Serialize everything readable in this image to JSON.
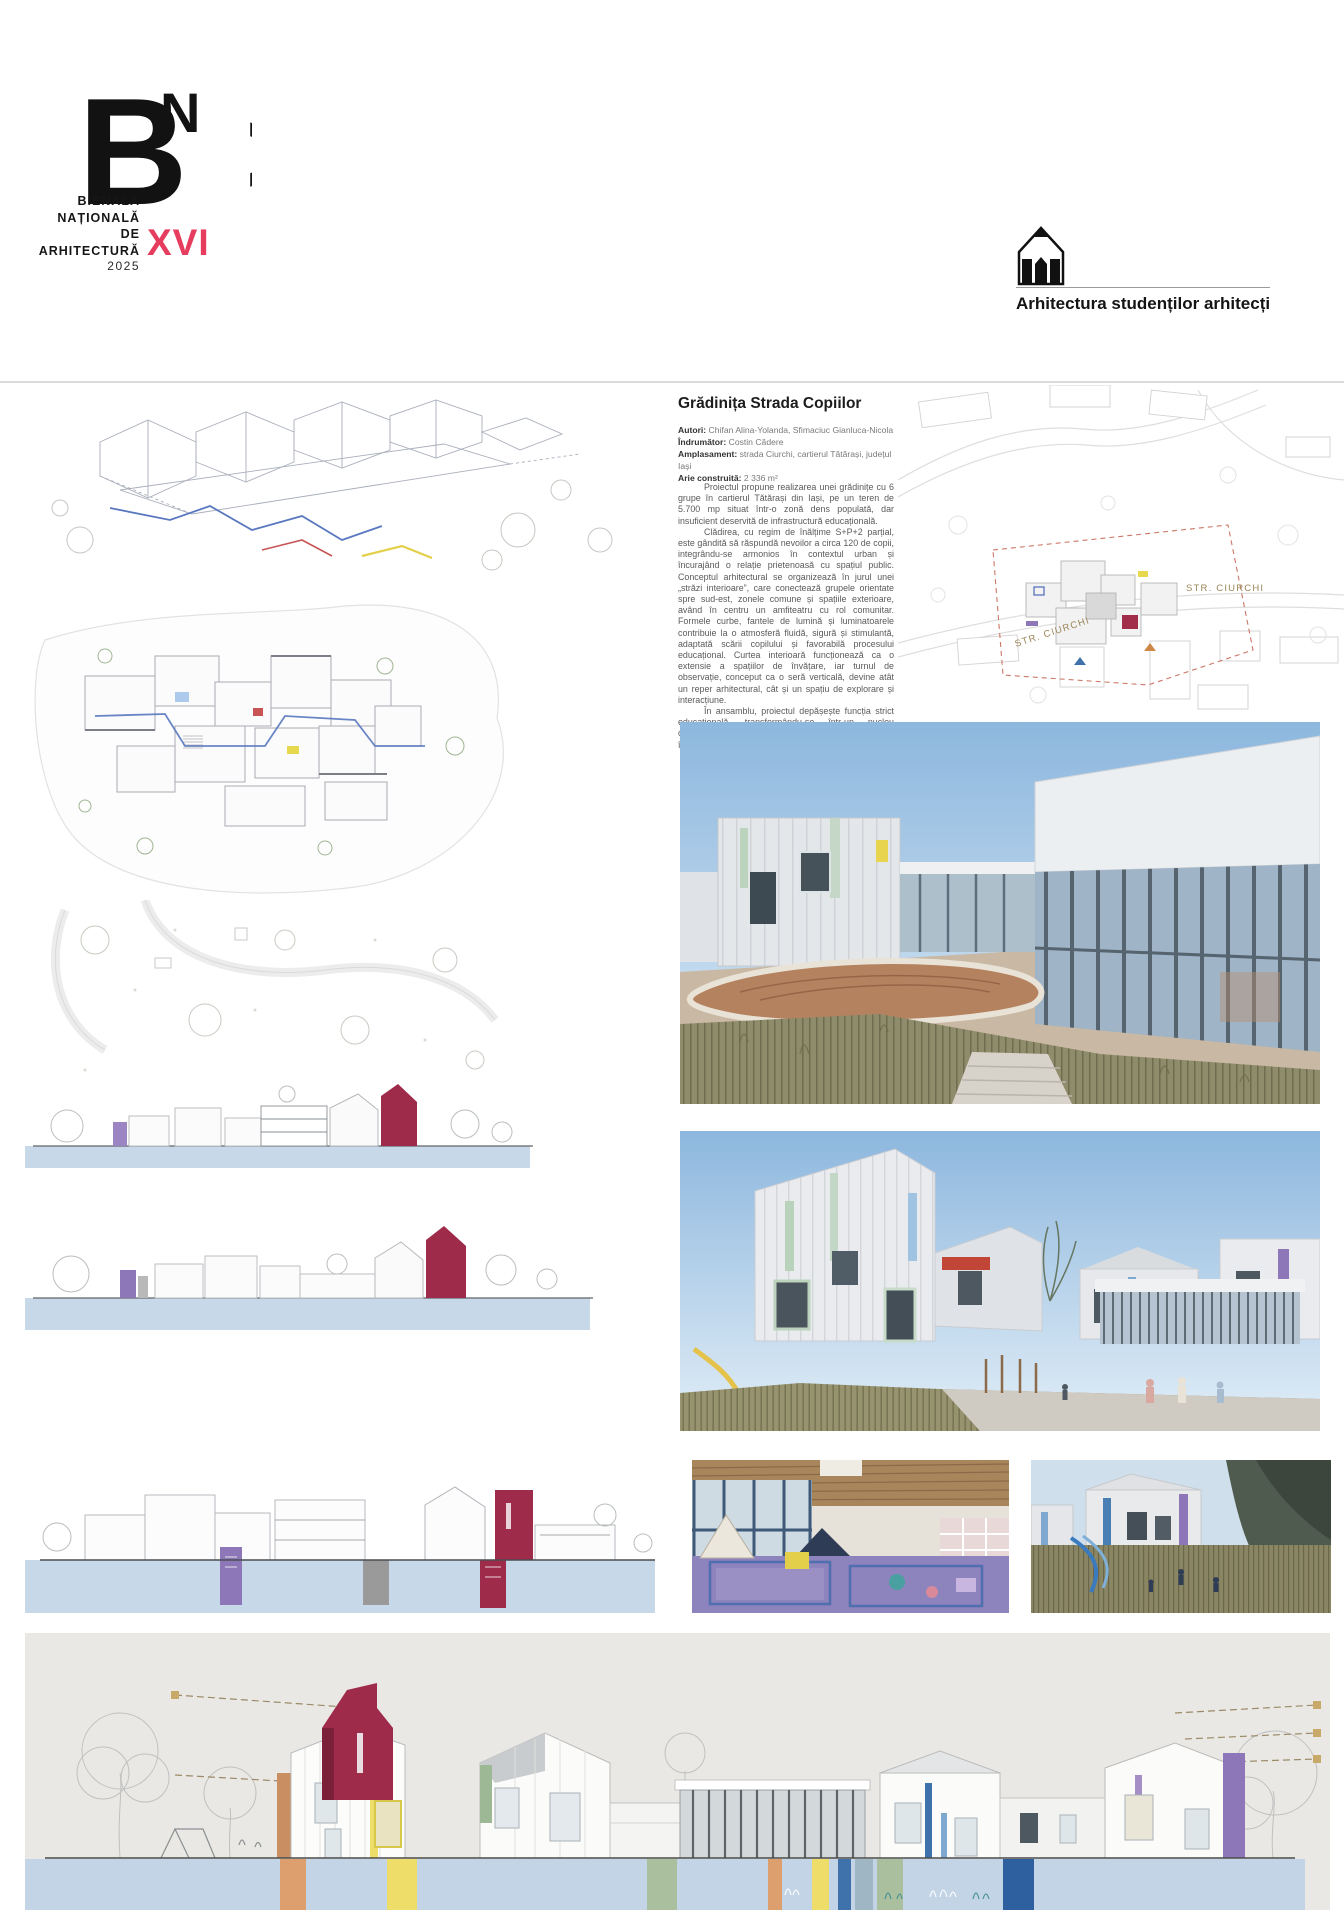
{
  "header": {
    "logo": {
      "mark": "BNA",
      "lines": [
        "BIENALA",
        "NAȚIONALĂ",
        "DE",
        "ARHITECTURĂ"
      ],
      "year": "2025",
      "edition": "XVI",
      "edition_color": "#e63d5f"
    },
    "section": {
      "icon": "pencil-house-icon",
      "label": "Arhitectura studenților arhitecți"
    }
  },
  "project": {
    "title": "Grădinița Strada Copiilor",
    "meta": [
      {
        "label": "Autori:",
        "value": " Chifan Alina-Yolanda, Sfimaciuc Gianluca-Nicola"
      },
      {
        "label": "Îndrumător:",
        "value": " Costin Cădere"
      },
      {
        "label": "Amplasament:",
        "value": " strada Ciurchi, cartierul Tătărași, județul Iași"
      },
      {
        "label": "Arie construită:",
        "value": " 2 336 m²"
      }
    ],
    "paragraphs": [
      "Proiectul propune realizarea unei grădinițe cu 6 grupe în cartierul Tătărași din Iași, pe un teren de 5.700 mp situat într-o zonă dens populată, dar insuficient deservită de infrastructură educațională.",
      "Clădirea, cu regim de înălțime S+P+2 parțial, este gândită să răspundă nevoilor a circa 120 de copii, integrându-se armonios în contextul urban și încurajând o relație prietenoasă cu spațiul public. Conceptul arhitectural se organizează în jurul unei „străzi interioare”, care conectează grupele orientate spre sud-est, zonele comune și spațiile exterioare, având în centru un amfiteatru cu rol comunitar. Formele curbe, fantele de lumină și luminatoarele contribuie la o atmosferă fluidă, sigură și stimulantă, adaptată scării copilului și favorabilă procesului educațional. Curtea interioară funcționează ca o extensie a spațiilor de învățare, iar turnul de observație, conceput ca o seră verticală, devine atât un reper arhitectural, cât și un spațiu de explorare și interacțiune.",
      "În ansamblu, proiectul depășește funcția strict educațională, transformându-se într-un nucleu comunitar și într-un spațiu de descoperire, joc și dialog între copii, părinți și comunitate."
    ]
  },
  "site_plan": {
    "street_label_1": "STR. CIURCHI",
    "street_label_2": "STR. CIURCHI"
  },
  "palette": {
    "accent_crimson": "#9e2b49",
    "accent_purple": "#8d77b8",
    "accent_yellow": "#eedd68",
    "accent_sage": "#a9bf9e",
    "accent_orange": "#dd9f6e",
    "accent_blue": "#3f72ab",
    "ground_band_blue": "#c3d4e6",
    "panel_gray": "#eae8e4",
    "boundary_dashed_red": "#cc7766"
  },
  "figures": [
    "axonometric-drawing",
    "ground-floor-plan",
    "landscape-plan",
    "elevation-strip-1",
    "elevation-strip-2",
    "section-strip",
    "site-plan",
    "courtyard-render",
    "street-render",
    "interior-render",
    "playground-render",
    "long-elevation"
  ]
}
